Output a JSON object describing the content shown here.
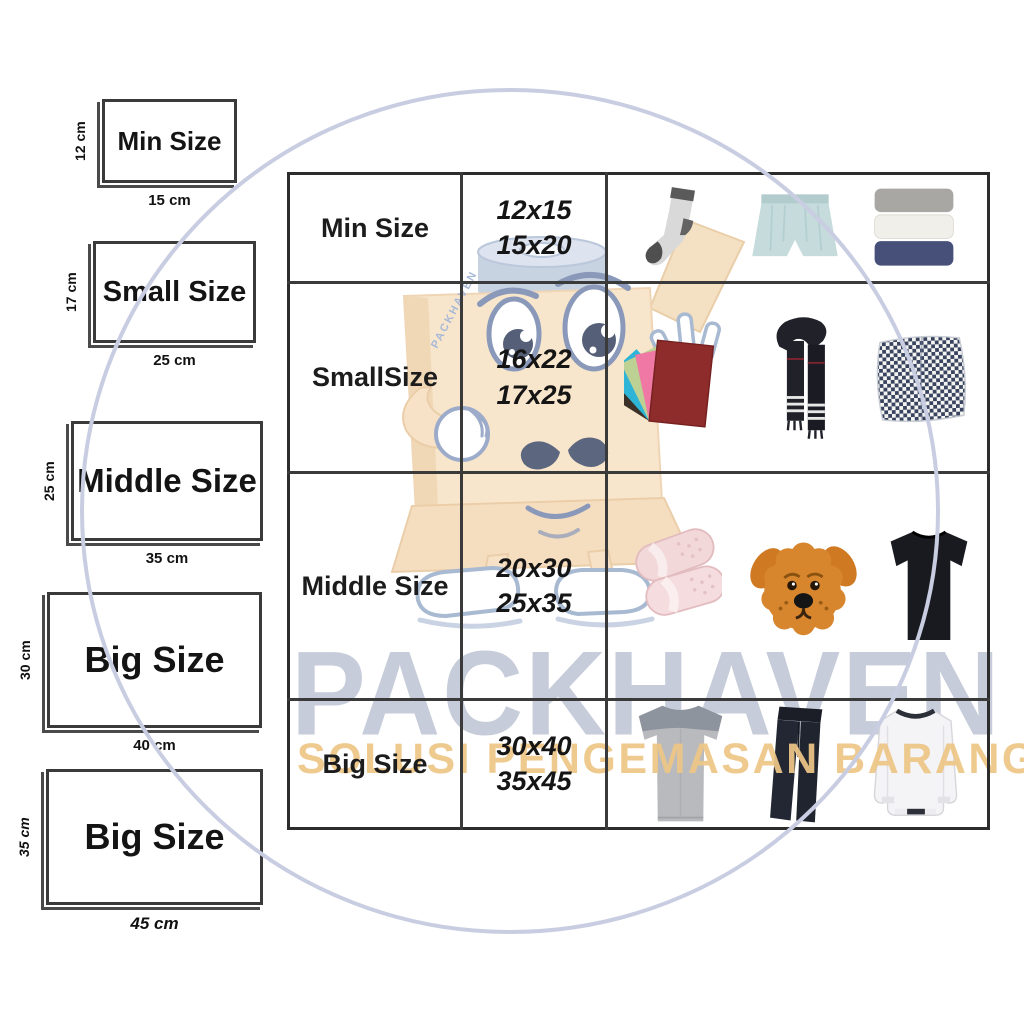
{
  "watermark": {
    "title": "PACKHAVEN",
    "subtitle": "SOLUSI PENGEMASAN BARANG",
    "title_color": "#c6ccd9",
    "subtitle_color": "#eec687",
    "circle_color": "#c9cde2",
    "mascot": {
      "label": "PACKHAVEN",
      "box_color": "#f8e3c6",
      "tape_color": "#c2cedf",
      "outline_color": "#7a8cb0"
    }
  },
  "size_diagrams": [
    {
      "label": "Min Size",
      "height": "12 cm",
      "width": "15 cm"
    },
    {
      "label": "Small Size",
      "height": "17 cm",
      "width": "25 cm"
    },
    {
      "label": "Middle Size",
      "height": "25 cm",
      "width": "35 cm"
    },
    {
      "label": "Big Size",
      "height": "30 cm",
      "width": "40 cm"
    },
    {
      "label": "Big Size",
      "height": "35 cm",
      "width": "45 cm"
    }
  ],
  "table": {
    "rows": [
      {
        "label": "Min Size",
        "sizes": [
          "12x15",
          "15x20"
        ],
        "items": [
          "sock",
          "boxer-briefs",
          "folded-towels"
        ]
      },
      {
        "label": "SmallSize",
        "sizes": [
          "16x22",
          "17x25"
        ],
        "items": [
          "envelopes",
          "scarf",
          "plaid-pillow"
        ]
      },
      {
        "label": "Middle Size",
        "sizes": [
          "20x30",
          "25x35"
        ],
        "items": [
          "slippers",
          "plush-dog",
          "black-tshirt"
        ]
      },
      {
        "label": "Big Size",
        "sizes": [
          "30x40",
          "35x45"
        ],
        "items": [
          "gray-tshirt",
          "pants",
          "white-sweatshirt"
        ]
      }
    ]
  }
}
